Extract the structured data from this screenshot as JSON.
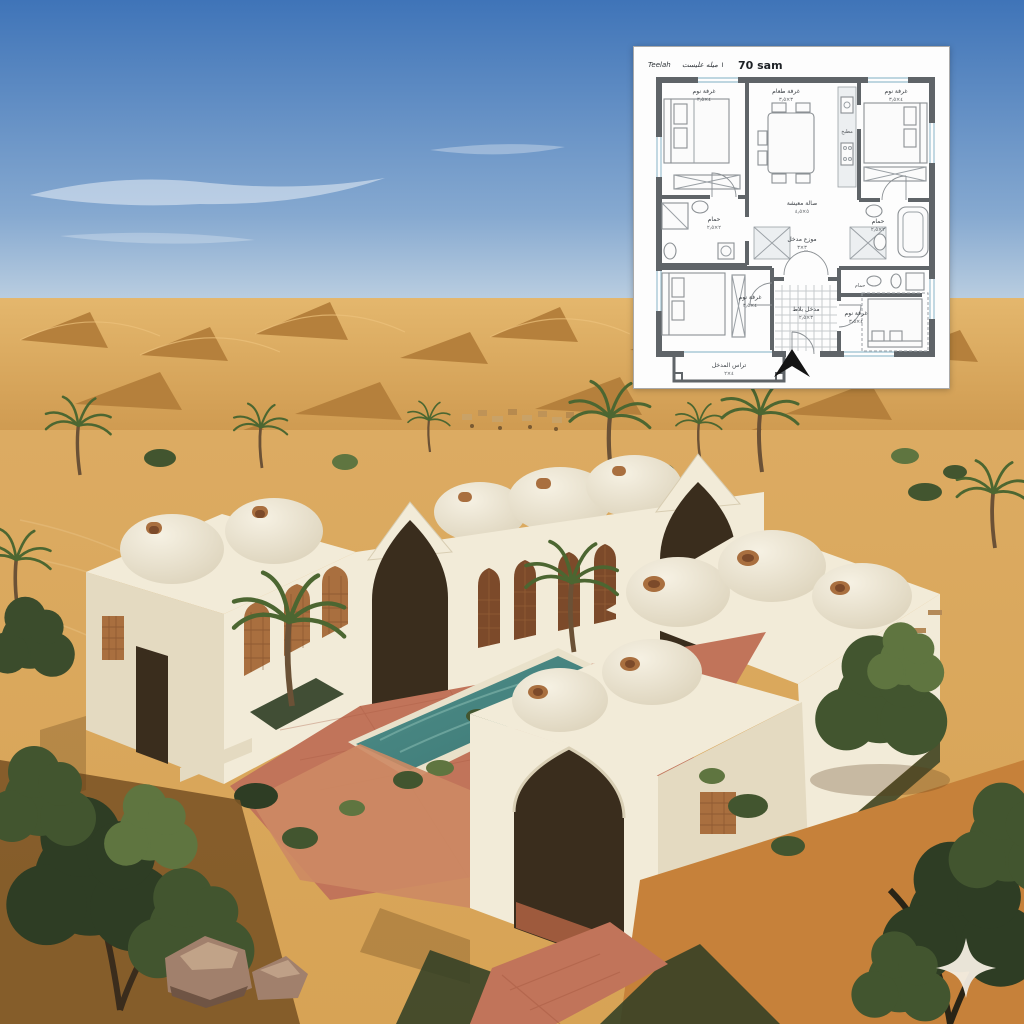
{
  "colors": {
    "sky_top": "#3f74b8",
    "sky_horizon": "#dfe8ec",
    "dune_light": "#ddad62",
    "dune_shadow": "#b5803c",
    "sand_mid": "#d7a355",
    "sand_fore": "#c08038",
    "wall_light": "#f2ebd8",
    "wall_mid": "#e4dac1",
    "wall_shade": "#cfc3a6",
    "dome_light": "#f6f1e3",
    "dome_shade": "#d9cfb6",
    "terracotta_screen": "#a96f3f",
    "terracotta_dark": "#7c4a2a",
    "paving": "#c1745a",
    "paving_dark": "#a85a42",
    "pool": "#4f908b",
    "pool_deep": "#3c7673",
    "green_dark": "#2e3d24",
    "green_mid": "#42552f",
    "green_light": "#5f7540",
    "palm_green": "#4c6631",
    "rock": "#a1806c",
    "opening_dark": "#3a2d1d",
    "plan_wall": "#5f6468",
    "plan_line": "#9aa0a5",
    "plan_window": "#a9c9d6",
    "plan_text": "#3c4146",
    "watermark": "#f3ede1"
  },
  "scene": {
    "subject": "desert courtyard house with domes, pool and palms",
    "watermark_icon": "four-point-sparkle"
  },
  "plan": {
    "title": {
      "name": "Teelah",
      "script": "١ ميله عليست",
      "area": "70 sam"
    },
    "rooms": [
      {
        "name": "bedroom-top-left",
        "label": "غرفة نوم",
        "dims": "٤×٣٫٥"
      },
      {
        "name": "dining-room",
        "label": "غرفة طعام",
        "dims": "٣×٣٫٥"
      },
      {
        "name": "kitchen",
        "label": "مطبخ",
        "dims": "٣×٢"
      },
      {
        "name": "bedroom-top-right",
        "label": "غرفة نوم",
        "dims": "٤×٣٫٥"
      },
      {
        "name": "bath-left",
        "label": "حمام",
        "dims": "٢×٢٫٥"
      },
      {
        "name": "bath-right",
        "label": "حمام",
        "dims": "٢×٢٫٥"
      },
      {
        "name": "living-hall",
        "label": "صالة معيشة",
        "dims": "٥×٤٫٥"
      },
      {
        "name": "hall-distributor",
        "label": "موزع مدخل",
        "dims": "٣×٣"
      },
      {
        "name": "bedroom-bottom-left",
        "label": "غرفة نوم",
        "dims": "٤×٣٫٥"
      },
      {
        "name": "entry-hall",
        "label": "مدخل بلاط",
        "dims": "٣×٢٫٥"
      },
      {
        "name": "bath-small",
        "label": "حمام",
        "dims": "٢×١٫٥"
      },
      {
        "name": "bedroom-bottom-right",
        "label": "غرفة نوم",
        "dims": "٤×٣٫٥"
      },
      {
        "name": "terrace",
        "label": "تراس المدخل",
        "dims": "٤×٢"
      }
    ]
  }
}
